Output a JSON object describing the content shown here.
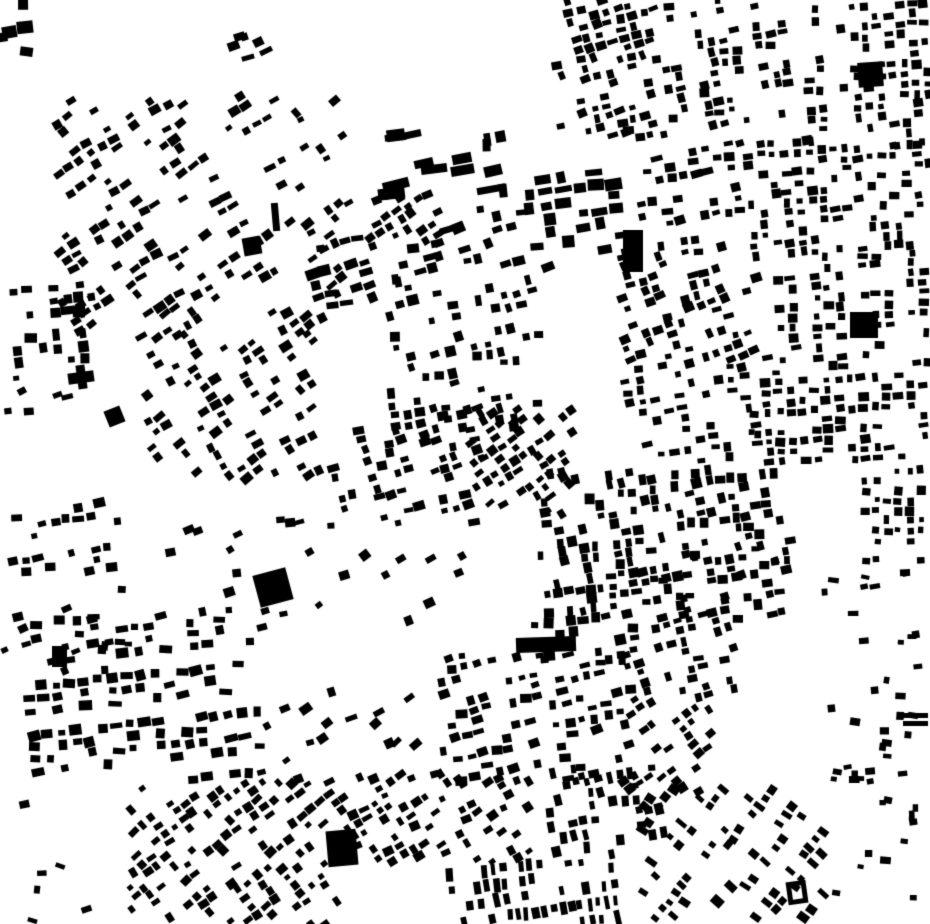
{
  "meta": {
    "kind": "figure-ground building footprint map",
    "description": "Black-on-white urban figure-ground map of building footprints; no text, axes or labels are rendered in the image",
    "width": 930,
    "height": 924,
    "background_color": "#ffffff",
    "building_color": "#000000",
    "seed": 42
  },
  "map": {
    "districts": [
      {
        "type": "scatter",
        "x": 2,
        "y": 2,
        "w": 38,
        "h": 58,
        "n": 5,
        "bw": 13,
        "bh": 11,
        "angle": 0,
        "angle_jitter": 10
      },
      {
        "type": "scatter",
        "x": 225,
        "y": 35,
        "w": 45,
        "h": 38,
        "n": 6,
        "bw": 10,
        "bh": 7,
        "angle": -20,
        "angle_jitter": 8
      },
      {
        "type": "grid",
        "x": 55,
        "y": 95,
        "w": 290,
        "h": 240,
        "angle": -33,
        "cell_u": 13,
        "cell_v": 11,
        "bw": 9,
        "bh": 7,
        "fill": 0.5,
        "angle_jitter": 8,
        "block_u": 85,
        "gap_u": 14,
        "block_v": 60,
        "gap_v": 10
      },
      {
        "type": "grid",
        "x": 140,
        "y": 330,
        "w": 180,
        "h": 148,
        "angle": -33,
        "cell_u": 13,
        "cell_v": 11,
        "bw": 9,
        "bh": 7,
        "fill": 0.5,
        "angle_jitter": 8,
        "block_u": 70,
        "gap_u": 12
      },
      {
        "type": "scatter",
        "x": 390,
        "y": 125,
        "w": 108,
        "h": 68,
        "n": 11,
        "bw": 23,
        "bh": 9,
        "angle": -10,
        "angle_jitter": 4
      },
      {
        "type": "scatter",
        "x": 478,
        "y": 133,
        "w": 40,
        "h": 58,
        "n": 4,
        "bw": 9,
        "bh": 15,
        "angle": -6,
        "angle_jitter": 6
      },
      {
        "type": "grid",
        "x": 558,
        "y": 0,
        "w": 100,
        "h": 135,
        "angle": -15,
        "cell_u": 12,
        "cell_v": 10,
        "bw": 8,
        "bh": 7,
        "fill": 0.55,
        "angle_jitter": 8,
        "block_u": 60,
        "gap_u": 12
      },
      {
        "type": "grid",
        "x": 665,
        "y": 0,
        "w": 135,
        "h": 122,
        "angle": -8,
        "cell_u": 12,
        "cell_v": 10,
        "bw": 8,
        "bh": 7,
        "fill": 0.5,
        "angle_jitter": 8,
        "block_u": 55,
        "gap_u": 10,
        "block_v": 55,
        "gap_v": 10
      },
      {
        "type": "grid",
        "x": 805,
        "y": 0,
        "w": 125,
        "h": 145,
        "angle": -4,
        "cell_u": 12,
        "cell_v": 10,
        "bw": 8,
        "bh": 7,
        "fill": 0.6,
        "angle_jitter": 7,
        "block_u": 65,
        "gap_u": 10
      },
      {
        "type": "grid",
        "x": 620,
        "y": 122,
        "w": 120,
        "h": 132,
        "angle": -10,
        "cell_u": 12,
        "cell_v": 11,
        "bw": 9,
        "bh": 7,
        "fill": 0.5,
        "angle_jitter": 8,
        "block_v": 45,
        "gap_v": 9
      },
      {
        "type": "grid",
        "x": 745,
        "y": 140,
        "w": 185,
        "h": 118,
        "angle": -4,
        "cell_u": 12,
        "cell_v": 10,
        "bw": 8,
        "bh": 7,
        "fill": 0.55,
        "angle_jitter": 7,
        "block_u": 60,
        "gap_u": 11
      },
      {
        "type": "grid",
        "x": 528,
        "y": 172,
        "w": 95,
        "h": 78,
        "angle": -8,
        "cell_u": 17,
        "cell_v": 13,
        "bw": 13,
        "bh": 9,
        "fill": 0.7,
        "angle_jitter": 5
      },
      {
        "type": "grid",
        "x": 310,
        "y": 238,
        "w": 130,
        "h": 70,
        "angle": -14,
        "cell_u": 13,
        "cell_v": 12,
        "bw": 10,
        "bh": 8,
        "fill": 0.5,
        "angle_jitter": 9
      },
      {
        "type": "grid",
        "x": 430,
        "y": 208,
        "w": 120,
        "h": 62,
        "angle": -14,
        "cell_u": 13,
        "cell_v": 12,
        "bw": 10,
        "bh": 8,
        "fill": 0.45,
        "angle_jitter": 9
      },
      {
        "type": "grid",
        "x": 345,
        "y": 193,
        "w": 95,
        "h": 50,
        "angle": -30,
        "cell_u": 12,
        "cell_v": 10,
        "bw": 8,
        "bh": 7,
        "fill": 0.45,
        "angle_jitter": 8
      },
      {
        "type": "grid",
        "x": 622,
        "y": 255,
        "w": 150,
        "h": 105,
        "angle": -18,
        "cell_u": 12,
        "cell_v": 10,
        "bw": 8,
        "bh": 7,
        "fill": 0.5,
        "angle_jitter": 7,
        "block_v": 40,
        "gap_v": 8
      },
      {
        "type": "grid",
        "x": 775,
        "y": 255,
        "w": 155,
        "h": 112,
        "angle": -3,
        "cell_u": 12,
        "cell_v": 10,
        "bw": 8,
        "bh": 7,
        "fill": 0.55,
        "angle_jitter": 7,
        "block_u": 50,
        "gap_u": 9
      },
      {
        "type": "grid",
        "x": 622,
        "y": 362,
        "w": 130,
        "h": 100,
        "angle": -8,
        "cell_u": 13,
        "cell_v": 11,
        "bw": 8,
        "bh": 7,
        "fill": 0.45,
        "angle_jitter": 8
      },
      {
        "type": "grid",
        "x": 755,
        "y": 372,
        "w": 175,
        "h": 92,
        "angle": -3,
        "cell_u": 12,
        "cell_v": 10,
        "bw": 8,
        "bh": 7,
        "fill": 0.5,
        "angle_jitter": 7
      },
      {
        "type": "grid",
        "x": 858,
        "y": 462,
        "w": 72,
        "h": 100,
        "angle": 0,
        "cell_u": 11,
        "cell_v": 10,
        "bw": 7,
        "bh": 7,
        "fill": 0.55,
        "angle_jitter": 6
      },
      {
        "type": "grid",
        "x": 390,
        "y": 280,
        "w": 150,
        "h": 150,
        "angle": -10,
        "cell_u": 13,
        "cell_v": 11,
        "bw": 8,
        "bh": 8,
        "fill": 0.33,
        "angle_jitter": 10
      },
      {
        "type": "grid",
        "x": 8,
        "y": 282,
        "w": 85,
        "h": 85,
        "angle": -4,
        "cell_u": 13,
        "cell_v": 12,
        "bw": 10,
        "bh": 9,
        "fill": 0.55,
        "angle_jitter": 6
      },
      {
        "type": "scatter",
        "x": 0,
        "y": 368,
        "w": 70,
        "h": 52,
        "n": 6,
        "bw": 9,
        "bh": 7,
        "angle": -15,
        "angle_jitter": 15
      },
      {
        "type": "grid",
        "x": 332,
        "y": 405,
        "w": 150,
        "h": 120,
        "angle": -16,
        "cell_u": 12,
        "cell_v": 10,
        "bw": 9,
        "bh": 7,
        "fill": 0.55,
        "angle_jitter": 7,
        "block_u": 55,
        "gap_u": 10,
        "block_v": 45,
        "gap_v": 9
      },
      {
        "type": "grid",
        "x": 470,
        "y": 408,
        "w": 105,
        "h": 105,
        "angle": -35,
        "cell_u": 11,
        "cell_v": 10,
        "bw": 8,
        "bh": 7,
        "fill": 0.5,
        "angle_jitter": 7
      },
      {
        "type": "grid",
        "x": 540,
        "y": 468,
        "w": 250,
        "h": 152,
        "angle": -8,
        "cell_u": 11,
        "cell_v": 10,
        "bw": 8,
        "bh": 8,
        "fill": 0.42,
        "angle_jitter": 8,
        "block_v": 40,
        "gap_v": 8
      },
      {
        "type": "grid",
        "x": 12,
        "y": 492,
        "w": 110,
        "h": 85,
        "angle": -10,
        "cell_u": 12,
        "cell_v": 11,
        "bw": 9,
        "bh": 7,
        "fill": 0.5,
        "angle_jitter": 8,
        "block_v": 40,
        "gap_v": 8
      },
      {
        "type": "scatter",
        "x": 0,
        "y": 585,
        "w": 140,
        "h": 85,
        "n": 16,
        "bw": 9,
        "bh": 7,
        "angle": -12,
        "angle_jitter": 18
      },
      {
        "type": "scatter",
        "x": 150,
        "y": 520,
        "w": 200,
        "h": 100,
        "n": 20,
        "bw": 9,
        "bh": 7,
        "angle": -20,
        "angle_jitter": 18
      },
      {
        "type": "scatter",
        "x": 350,
        "y": 545,
        "w": 120,
        "h": 85,
        "n": 8,
        "bw": 9,
        "bh": 7,
        "angle": -25,
        "angle_jitter": 12
      },
      {
        "type": "grid",
        "x": 28,
        "y": 618,
        "w": 240,
        "h": 165,
        "angle": -6,
        "cell_u": 14,
        "cell_v": 12,
        "bw": 10,
        "bh": 8,
        "fill": 0.5,
        "angle_jitter": 10,
        "block_u": 70,
        "gap_u": 12,
        "block_v": 55,
        "gap_v": 10
      },
      {
        "type": "scatter",
        "x": 0,
        "y": 790,
        "w": 120,
        "h": 130,
        "n": 6,
        "bw": 8,
        "bh": 6,
        "angle": 0,
        "angle_jitter": 20
      },
      {
        "type": "grid",
        "x": 128,
        "y": 782,
        "w": 215,
        "h": 142,
        "angle": -38,
        "cell_u": 12,
        "cell_v": 10,
        "bw": 8,
        "bh": 7,
        "fill": 0.55,
        "angle_jitter": 7,
        "block_v": 45,
        "gap_v": 9
      },
      {
        "type": "scatter",
        "x": 255,
        "y": 690,
        "w": 170,
        "h": 92,
        "n": 18,
        "bw": 9,
        "bh": 7,
        "angle": -30,
        "angle_jitter": 15
      },
      {
        "type": "grid",
        "x": 430,
        "y": 655,
        "w": 200,
        "h": 125,
        "angle": -12,
        "cell_u": 13,
        "cell_v": 11,
        "bw": 9,
        "bh": 7,
        "fill": 0.45,
        "angle_jitter": 10
      },
      {
        "type": "grid",
        "x": 340,
        "y": 775,
        "w": 190,
        "h": 88,
        "angle": -30,
        "cell_u": 12,
        "cell_v": 10,
        "bw": 8,
        "bh": 7,
        "fill": 0.5,
        "angle_jitter": 8
      },
      {
        "type": "grid",
        "x": 448,
        "y": 862,
        "w": 175,
        "h": 60,
        "angle": -8,
        "cell_u": 9,
        "cell_v": 16,
        "bw": 6,
        "bh": 11,
        "fill": 0.6,
        "angle_jitter": 5
      },
      {
        "type": "grid",
        "x": 545,
        "y": 768,
        "w": 120,
        "h": 96,
        "angle": -10,
        "cell_u": 11,
        "cell_v": 13,
        "bw": 7,
        "bh": 9,
        "fill": 0.5,
        "angle_jitter": 7
      },
      {
        "type": "grid",
        "x": 530,
        "y": 616,
        "w": 120,
        "h": 48,
        "angle": -5,
        "cell_u": 12,
        "cell_v": 11,
        "bw": 9,
        "bh": 8,
        "fill": 0.5,
        "angle_jitter": 7
      },
      {
        "type": "grid",
        "x": 620,
        "y": 598,
        "w": 115,
        "h": 102,
        "angle": -15,
        "cell_u": 12,
        "cell_v": 10,
        "bw": 8,
        "bh": 7,
        "fill": 0.55,
        "angle_jitter": 7,
        "block_u": 55,
        "gap_u": 10
      },
      {
        "type": "grid",
        "x": 620,
        "y": 700,
        "w": 95,
        "h": 92,
        "angle": -35,
        "cell_u": 11,
        "cell_v": 10,
        "bw": 8,
        "bh": 7,
        "fill": 0.45,
        "angle_jitter": 8
      },
      {
        "type": "grid",
        "x": 640,
        "y": 790,
        "w": 185,
        "h": 134,
        "angle": -52,
        "cell_u": 10,
        "cell_v": 13,
        "bw": 7,
        "bh": 9,
        "fill": 0.5,
        "angle_jitter": 6,
        "block_v": 40,
        "gap_v": 8
      },
      {
        "type": "scatter",
        "x": 820,
        "y": 560,
        "w": 108,
        "h": 360,
        "n": 46,
        "bw": 8,
        "bh": 6,
        "angle": 0,
        "angle_jitter": 12
      },
      {
        "type": "scatter",
        "x": 660,
        "y": 540,
        "w": 130,
        "h": 68,
        "n": 10,
        "bw": 8,
        "bh": 7,
        "angle": -10,
        "angle_jitter": 10
      }
    ],
    "landmarks": [
      {
        "name": "large-block-east",
        "x": 850,
        "y": 312,
        "w": 28,
        "h": 26,
        "angle": 0,
        "style": "solid"
      },
      {
        "name": "large-block-northeast",
        "x": 858,
        "y": 62,
        "w": 25,
        "h": 25,
        "angle": -4,
        "style": "solid"
      },
      {
        "name": "tall-slab-north",
        "x": 623,
        "y": 230,
        "w": 20,
        "h": 42,
        "angle": 0,
        "style": "solid"
      },
      {
        "name": "long-slab-center",
        "x": 516,
        "y": 637,
        "w": 60,
        "h": 15,
        "angle": -2,
        "style": "solid"
      },
      {
        "name": "block-southwest",
        "x": 52,
        "y": 646,
        "w": 15,
        "h": 21,
        "angle": 0,
        "style": "solid"
      },
      {
        "name": "rotated-square-center-west",
        "x": 256,
        "y": 571,
        "w": 34,
        "h": 33,
        "angle": -15,
        "style": "solid"
      },
      {
        "name": "rotated-square-west",
        "x": 106,
        "y": 408,
        "w": 17,
        "h": 17,
        "angle": -22,
        "style": "solid"
      },
      {
        "name": "large-block-south",
        "x": 327,
        "y": 830,
        "w": 30,
        "h": 36,
        "angle": -5,
        "style": "solid"
      },
      {
        "name": "courtyard-block-southeast",
        "x": 787,
        "y": 881,
        "w": 20,
        "h": 23,
        "angle": -8,
        "style": "ring"
      },
      {
        "name": "twin-bar-east-1",
        "x": 903,
        "y": 713,
        "w": 25,
        "h": 5,
        "angle": 0,
        "style": "solid"
      },
      {
        "name": "twin-bar-east-2",
        "x": 903,
        "y": 721,
        "w": 25,
        "h": 5,
        "angle": 0,
        "style": "solid"
      },
      {
        "name": "cross-building-wing-h",
        "x": 68,
        "y": 372,
        "w": 26,
        "h": 11,
        "angle": -8,
        "style": "solid"
      },
      {
        "name": "cross-building-wing-v",
        "x": 77,
        "y": 365,
        "w": 9,
        "h": 24,
        "angle": -8,
        "style": "solid"
      },
      {
        "name": "square-northwest",
        "x": 243,
        "y": 237,
        "w": 18,
        "h": 18,
        "angle": -10,
        "style": "solid"
      },
      {
        "name": "bar-northwest",
        "x": 272,
        "y": 203,
        "w": 7,
        "h": 28,
        "angle": -5,
        "style": "solid"
      }
    ]
  }
}
